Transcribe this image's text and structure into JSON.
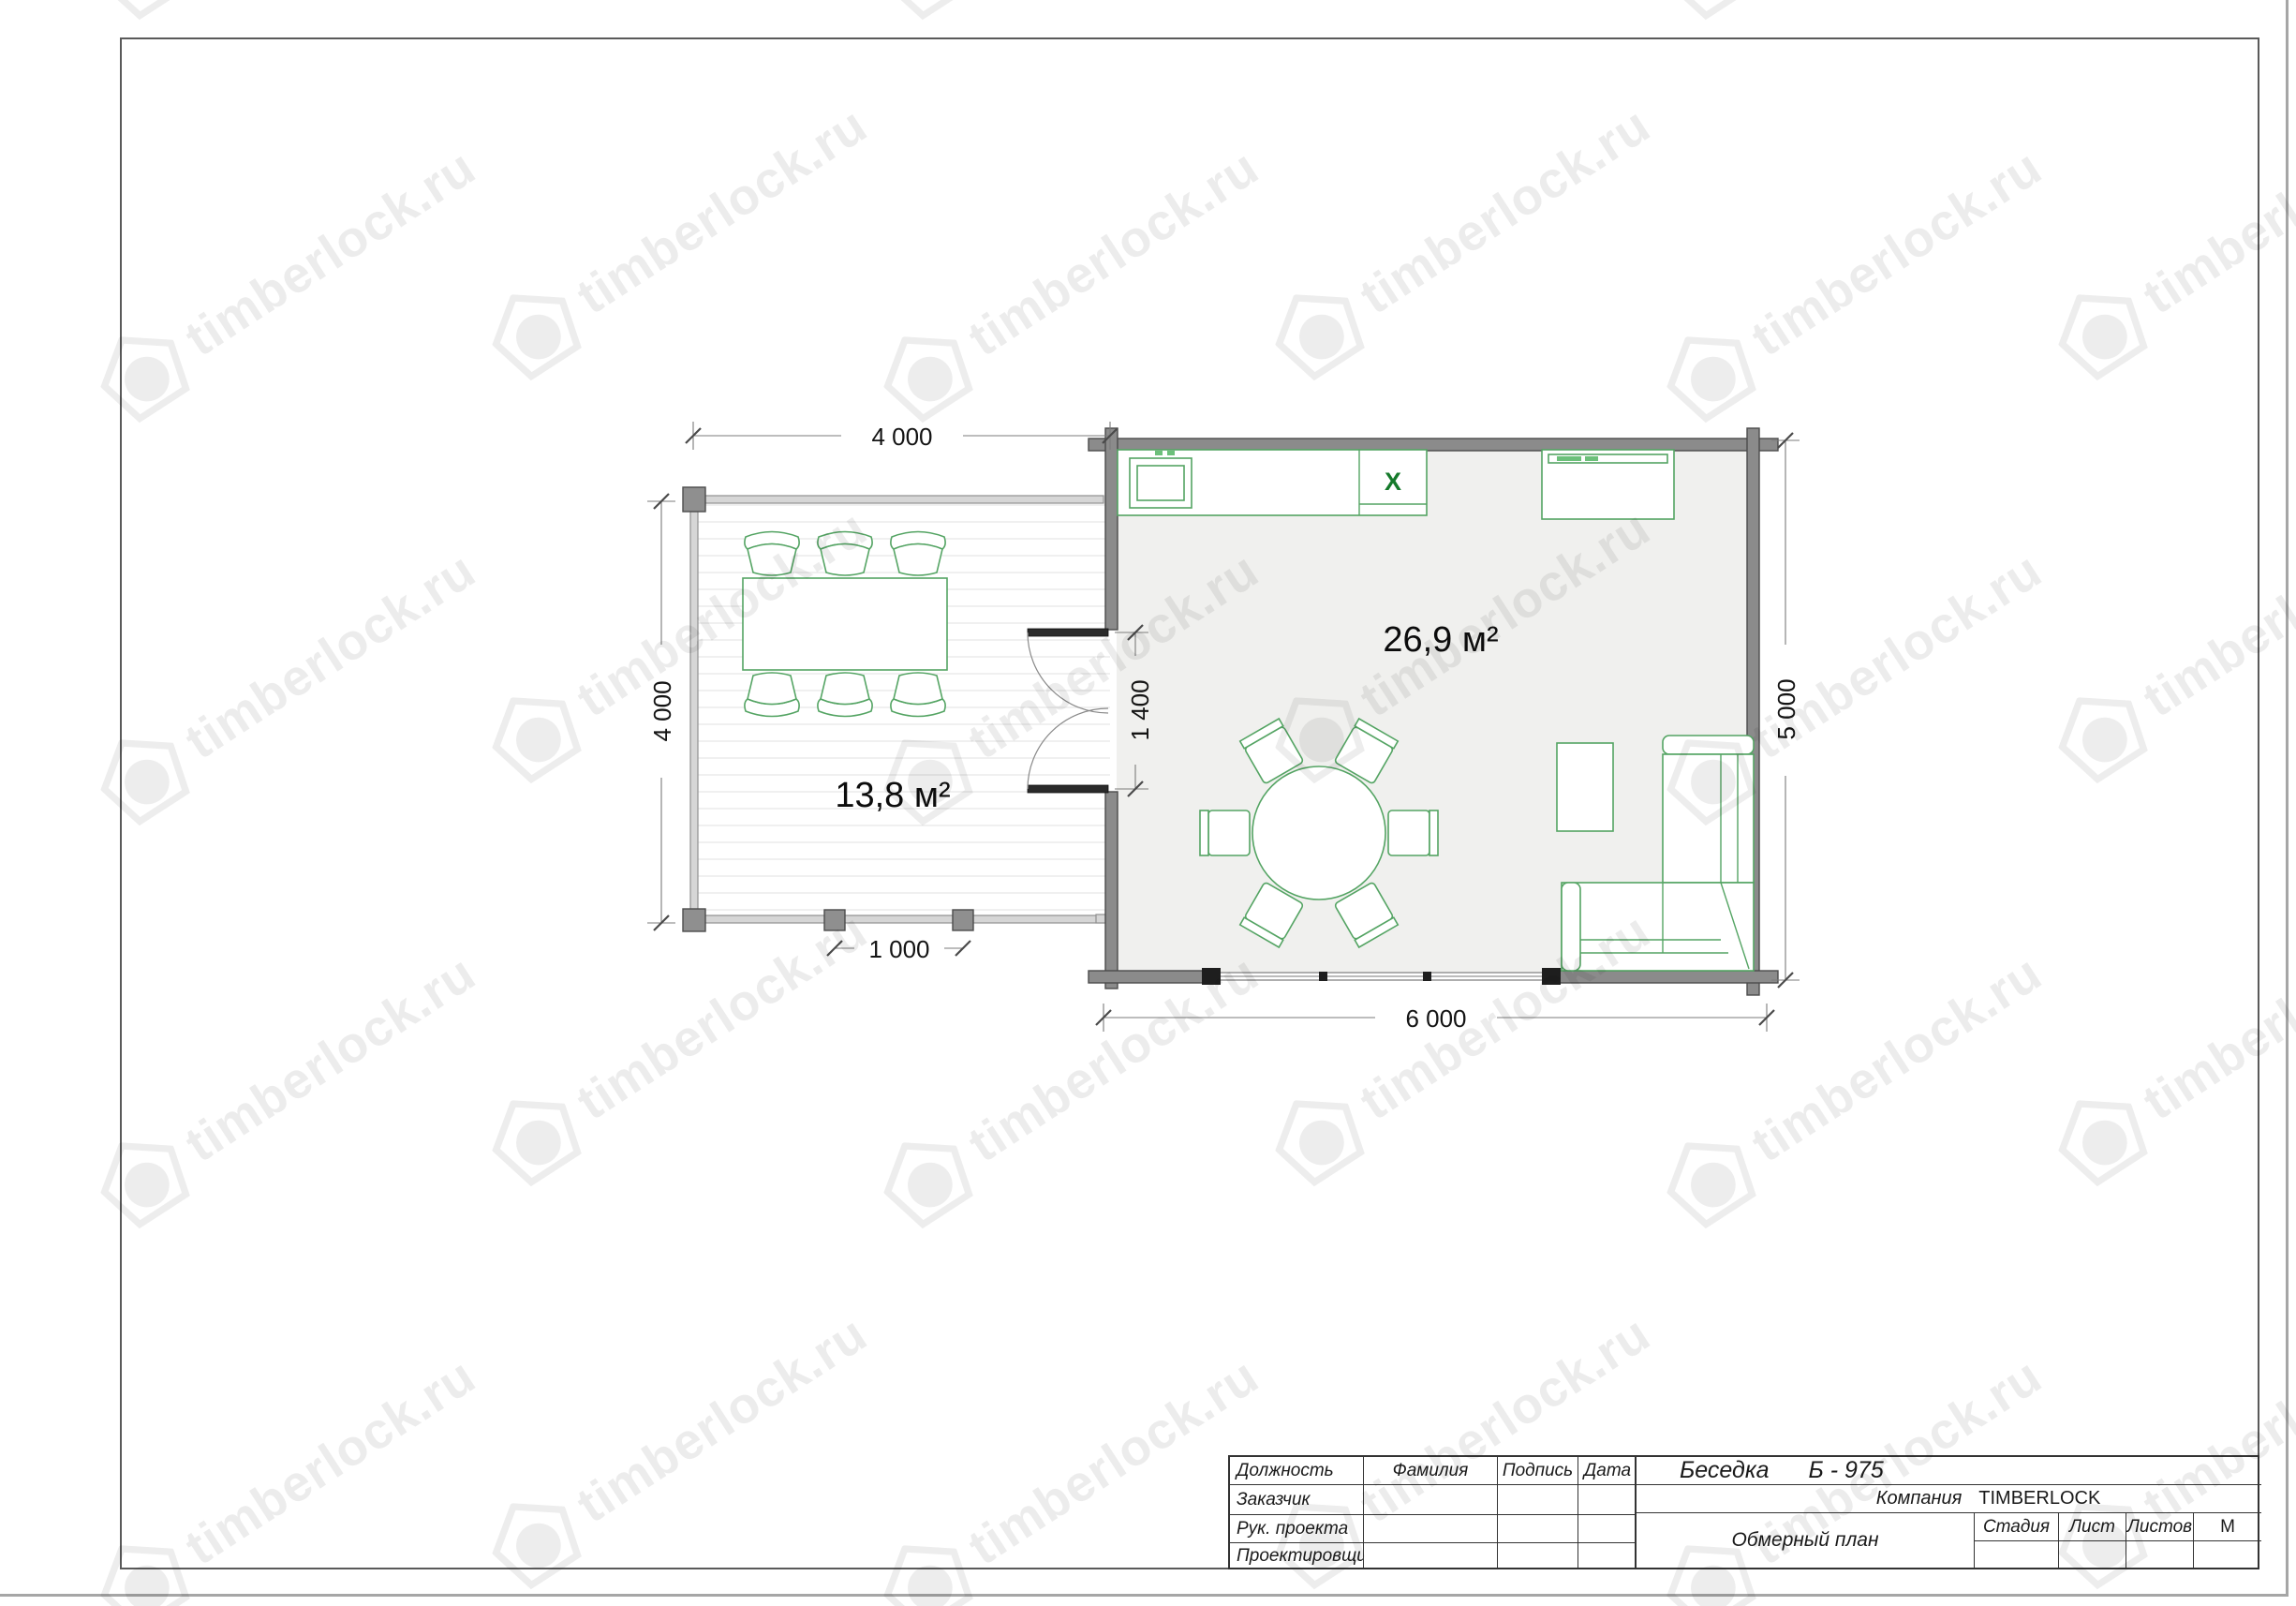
{
  "watermark": {
    "text": "timberlock.ru"
  },
  "plan": {
    "labels": {
      "terrace_area": "13,8 м²",
      "room_area": "26,9 м²",
      "hob_mark": "X"
    },
    "dimensions": {
      "terrace_width": "4 000",
      "terrace_depth": "4 000",
      "door_width": "1 400",
      "room_width": "6 000",
      "room_depth": "5 000",
      "post_spacing": "1 000"
    }
  },
  "title_block": {
    "position_rows": [
      "Должность",
      "Заказчик",
      "Рук. проекта",
      "Проектировщик"
    ],
    "header": {
      "surname": "Фамилия",
      "signature": "Подпись",
      "date": "Дата"
    },
    "project_type": "Беседка",
    "project_code": "Б - 975",
    "company_label": "Компания",
    "company_name": "TIMBERLOCK",
    "drawing_name": "Обмерный план",
    "stage_label": "Стадия",
    "sheet_label": "Лист",
    "sheets_label": "Листов",
    "scale_label": "М"
  }
}
